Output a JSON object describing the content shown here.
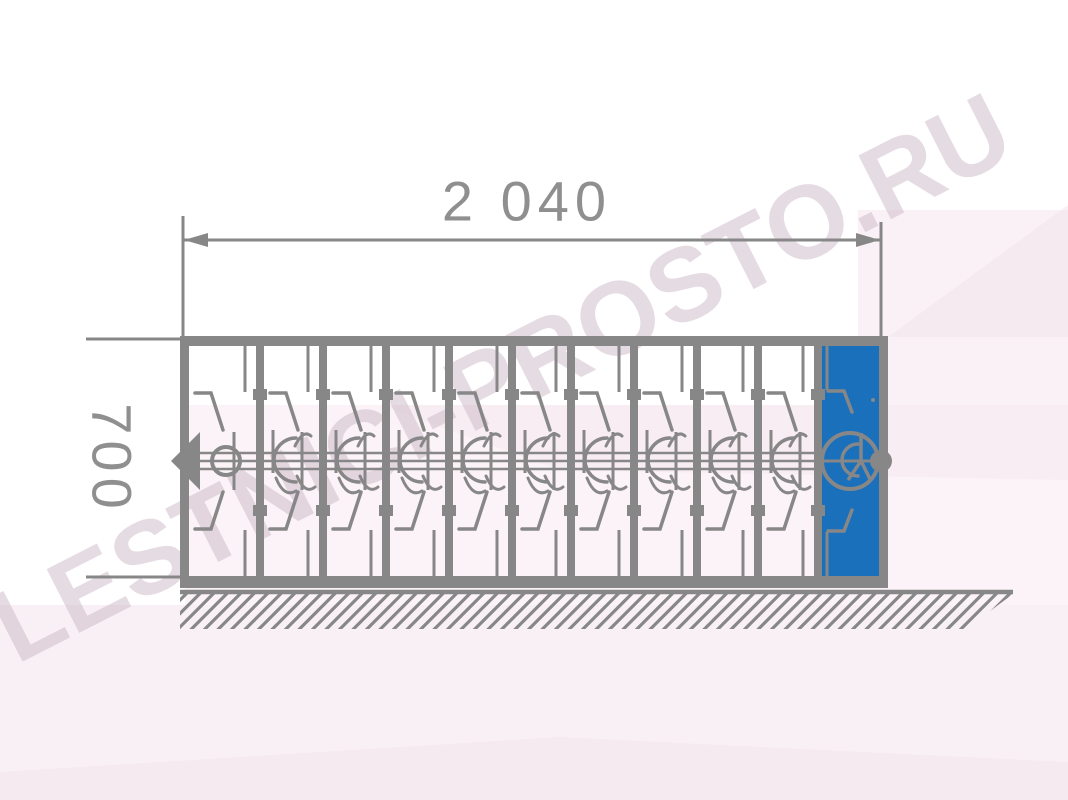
{
  "drawing": {
    "type": "technical-elevation",
    "subject": "sliding-accordion-grille-section",
    "dimensions": {
      "width_label": "2 040",
      "width_value": 2040,
      "height_label": "700",
      "height_value": 700
    },
    "grille": {
      "total_sections": 11,
      "white_sections": 10,
      "highlighted_sections": 1,
      "has_left_arrow": true,
      "has_right_knob": true,
      "ground_hatched": true
    },
    "colors": {
      "line": "#878787",
      "line_dark": "#7e7e7e",
      "dim_text": "#8f8f8f",
      "highlight": "#1b70bc",
      "watermark": "#cdb9c6",
      "tint1": "#f8edf3",
      "tint2": "#f9eef4",
      "tint3": "#f3e3ec",
      "tint4": "#f5e7ef"
    },
    "watermark": {
      "text": "LESTNICI-PROSTO.RU"
    }
  }
}
